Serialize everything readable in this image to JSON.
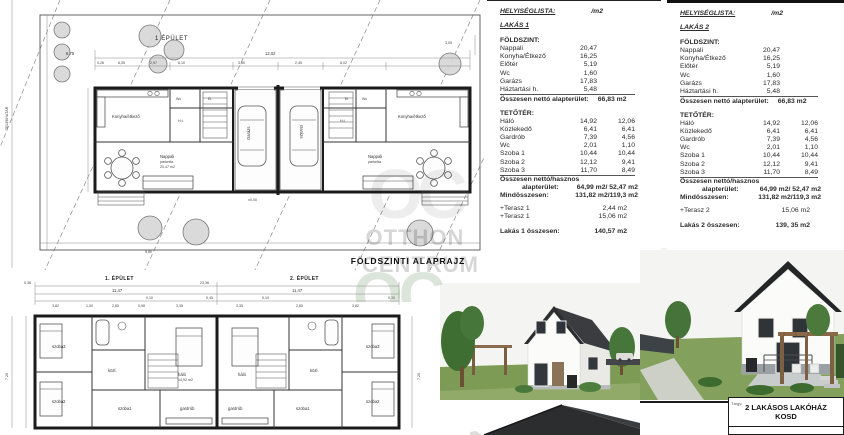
{
  "watermark": {
    "logo": "OC",
    "line1": "OTTHON",
    "line2": "CENTRUM"
  },
  "site_plan": {
    "building_label": "1 ÉPÜLET",
    "caption": "FÖLDSZINTI ALAPRAJZ",
    "boundary_label": "TELEKHATÁR",
    "level": "±0,00",
    "dims": [
      "12,02",
      "6,75",
      "0,26",
      "6,35",
      "2,97",
      "6,10",
      "3,60",
      "2,45",
      "8,02",
      "3,05",
      "5,80"
    ],
    "rooms": {
      "kitchen": "Konyha/étkező",
      "living": "Nappali",
      "living_area": "20,47 m2",
      "material": "parketta",
      "garage": "Garázs",
      "entry": "El.",
      "household": "H.t.",
      "wc": "Wc"
    }
  },
  "attic_plan": {
    "building1_label": "1. ÉPÜLET",
    "building2_label": "2. ÉPÜLET",
    "dims": [
      "11,47",
      "0,10",
      "3,82",
      "1,00",
      "2,80",
      "0,98",
      "3,35",
      "0,45",
      "0,35",
      "7,20",
      "23,36",
      "0,36"
    ],
    "rooms": {
      "bedroom": "háló",
      "bedroom_area": "14,92 m2",
      "material": "parketta",
      "room1": "szoba1",
      "room2": "szoba2",
      "room3": "szoba3",
      "hall": "közl.",
      "wardrobe": "gardrób"
    }
  },
  "panels": [
    {
      "header": "HELYISÉGLISTA:",
      "unit": "/m2",
      "apartment": "LAKÁS 1",
      "ground_title": "FÖLDSZINT:",
      "ground_rows": [
        [
          "Nappali",
          "20,47",
          ""
        ],
        [
          "Konyha/Étkező",
          "16,25",
          ""
        ],
        [
          "Előtér",
          "5,19",
          ""
        ],
        [
          "Wc",
          "1,60",
          ""
        ],
        [
          "Garázs",
          "17,83",
          ""
        ],
        [
          "Háztartási h.",
          "5,48",
          ""
        ]
      ],
      "ground_total_label": "Összesen nettó alapterület:",
      "ground_total_value": "66,83 m2",
      "attic_title": "TETŐTÉR:",
      "attic_rows": [
        [
          "Háló",
          "14,92",
          "12,06"
        ],
        [
          "Közlekedő",
          "6,41",
          "6,41"
        ],
        [
          "Gardrób",
          "7,39",
          "4,56"
        ],
        [
          "Wc",
          "2,01",
          "1,10"
        ],
        [
          "Szoba 1",
          "10,44",
          "10,44"
        ],
        [
          "Szoba 2",
          "12,12",
          "9,41"
        ],
        [
          "Szoba 3",
          "11,70",
          "8,49"
        ]
      ],
      "net_label1": "Összesen nettó/hasznos",
      "net_label2": "alapterület:",
      "net_value": "64,99 m2/ 52,47 m2",
      "grand_label": "Mindösszesen:",
      "grand_value": "131,82 m2/119,3 m2",
      "terrace_rows": [
        [
          "+Terasz 1",
          "2,44 m2"
        ],
        [
          "+Terasz 1",
          "15,06 m2"
        ]
      ],
      "sum_label": "Lakás 1 összesen:",
      "sum_value": "140,57 m2"
    },
    {
      "header": "HELYISÉGLISTA:",
      "unit": "/m2",
      "apartment": "LAKÁS 2",
      "ground_title": "FÖLDSZINT:",
      "ground_rows": [
        [
          "Nappali",
          "20,47",
          ""
        ],
        [
          "Konyha/Étkező",
          "16,25",
          ""
        ],
        [
          "Előtér",
          "5,19",
          ""
        ],
        [
          "Wc",
          "1,60",
          ""
        ],
        [
          "Garázs",
          "17,83",
          ""
        ],
        [
          "Háztartási h.",
          "5,48",
          ""
        ]
      ],
      "ground_total_label": "Összesen nettó alapterület:",
      "ground_total_value": "66,83 m2",
      "attic_title": "TETŐTÉR:",
      "attic_rows": [
        [
          "Háló",
          "14,92",
          "12,06"
        ],
        [
          "Közlekedő",
          "6,41",
          "6,41"
        ],
        [
          "Gardrób",
          "7,39",
          "4,56"
        ],
        [
          "Wc",
          "2,01",
          "1,10"
        ],
        [
          "Szoba 1",
          "10,44",
          "10,44"
        ],
        [
          "Szoba 2",
          "12,12",
          "9,41"
        ],
        [
          "Szoba 3",
          "11,70",
          "8,49"
        ]
      ],
      "net_label1": "Összesen nettó/hasznos",
      "net_label2": "alapterület:",
      "net_value": "64,99 m2/ 52,47 m2",
      "grand_label": "Mindösszesen:",
      "grand_value": "131,82 m2/119,3 m2",
      "terrace_rows": [
        [
          "+Terasz 2",
          "15,06 m2"
        ]
      ],
      "sum_label": "Lakás 2 összesen:",
      "sum_value": "139, 35 m2"
    }
  ],
  "title_block": {
    "field_label": "Tárgy:",
    "project_line1": "2 LAKÁSOS LAKÓHÁZ",
    "project_line2": "KOSD"
  }
}
